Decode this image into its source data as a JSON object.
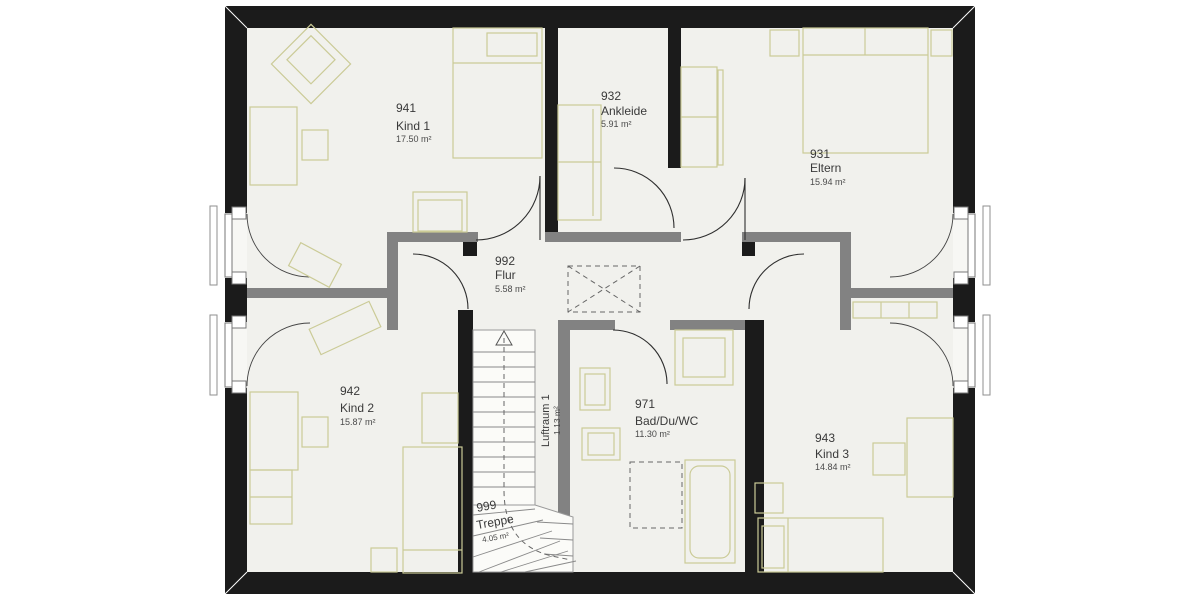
{
  "plan": {
    "rooms": [
      {
        "id": "941",
        "name": "Kind 1",
        "area": "17.50 m²"
      },
      {
        "id": "932",
        "name": "Ankleide",
        "area": "5.91 m²"
      },
      {
        "id": "931",
        "name": "Eltern",
        "area": "15.94 m²"
      },
      {
        "id": "992",
        "name": "Flur",
        "area": "5.58 m²"
      },
      {
        "id": "942",
        "name": "Kind 2",
        "area": "15.87 m²"
      },
      {
        "id": "971",
        "name": "Bad/Du/WC",
        "area": "11.30 m²"
      },
      {
        "id": "943",
        "name": "Kind 3",
        "area": "14.84 m²"
      },
      {
        "id": "999",
        "name": "Treppe",
        "area": "4.05 m²"
      }
    ],
    "void_label": {
      "name": "Luftraum 1",
      "area": "1.13 m²"
    },
    "colors": {
      "exterior_wall": "#1b1b1b",
      "interior_wall": "#828282",
      "furniture_outline": "#cbcb97",
      "floor": "#f1f1ed",
      "background": "#ffffff"
    }
  }
}
